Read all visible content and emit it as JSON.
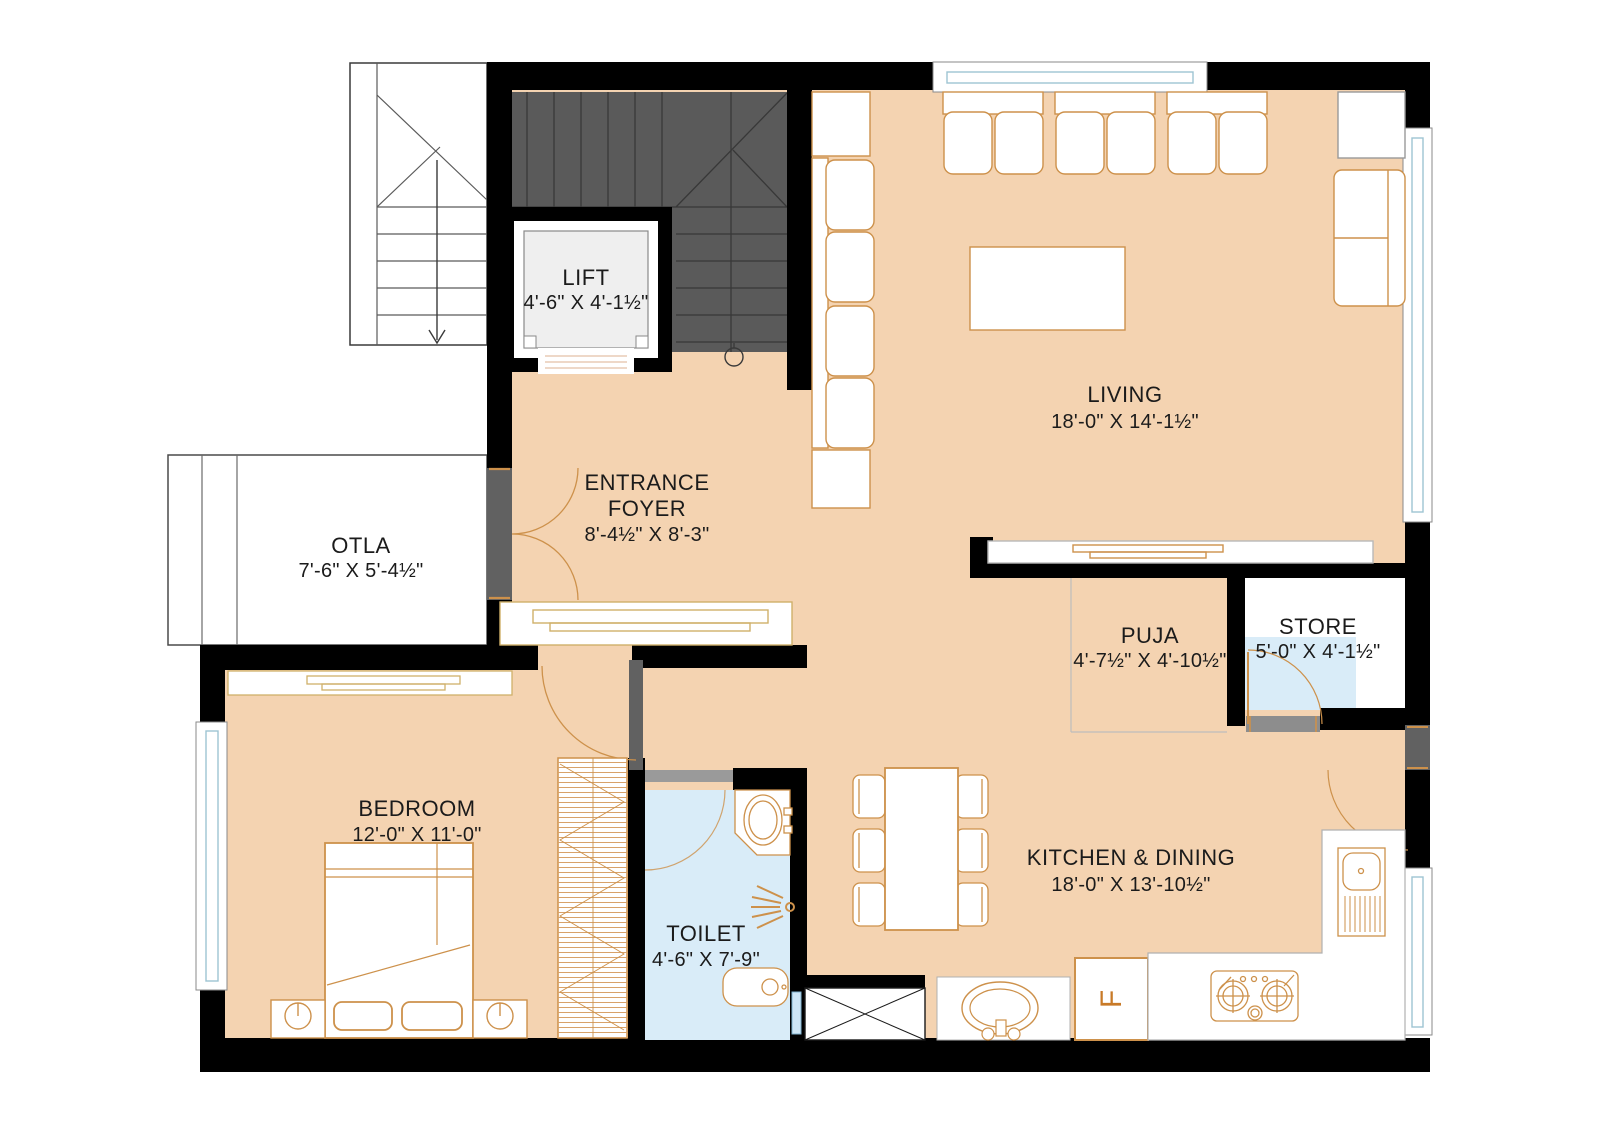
{
  "plan": {
    "rooms": {
      "lift": {
        "name": "LIFT",
        "dims": "4'-6\" X 4'-1½\""
      },
      "living": {
        "name": "LIVING",
        "dims": "18'-0\" X 14'-1½\""
      },
      "entrance_foyer": {
        "name_line1": "ENTRANCE",
        "name_line2": "FOYER",
        "dims": "8'-4½\" X 8'-3\""
      },
      "otla": {
        "name": "OTLA",
        "dims": "7'-6\" X 5'-4½\""
      },
      "puja": {
        "name": "PUJA",
        "dims": "4'-7½\" X 4'-10½\""
      },
      "store": {
        "name": "STORE",
        "dims": "5'-0\" X 4'-1½\""
      },
      "bedroom": {
        "name": "BEDROOM",
        "dims": "12'-0\" X 11'-0\""
      },
      "toilet": {
        "name": "TOILET",
        "dims": "4'-6\" X 7'-9\""
      },
      "kitchen_dining": {
        "name": "KITCHEN  & DINING",
        "dims": "18'-0\" X 13'-10½\""
      }
    },
    "appliance_labels": {
      "fridge": "F"
    },
    "colors": {
      "wall": "#000000",
      "floor": "#f4d3b1",
      "wet_floor": "#d9ecf8",
      "staircase": "#5a5a5a",
      "door": "#616161",
      "furniture_outline": "#cd914b",
      "window_glass": "#9ec4d2"
    }
  }
}
